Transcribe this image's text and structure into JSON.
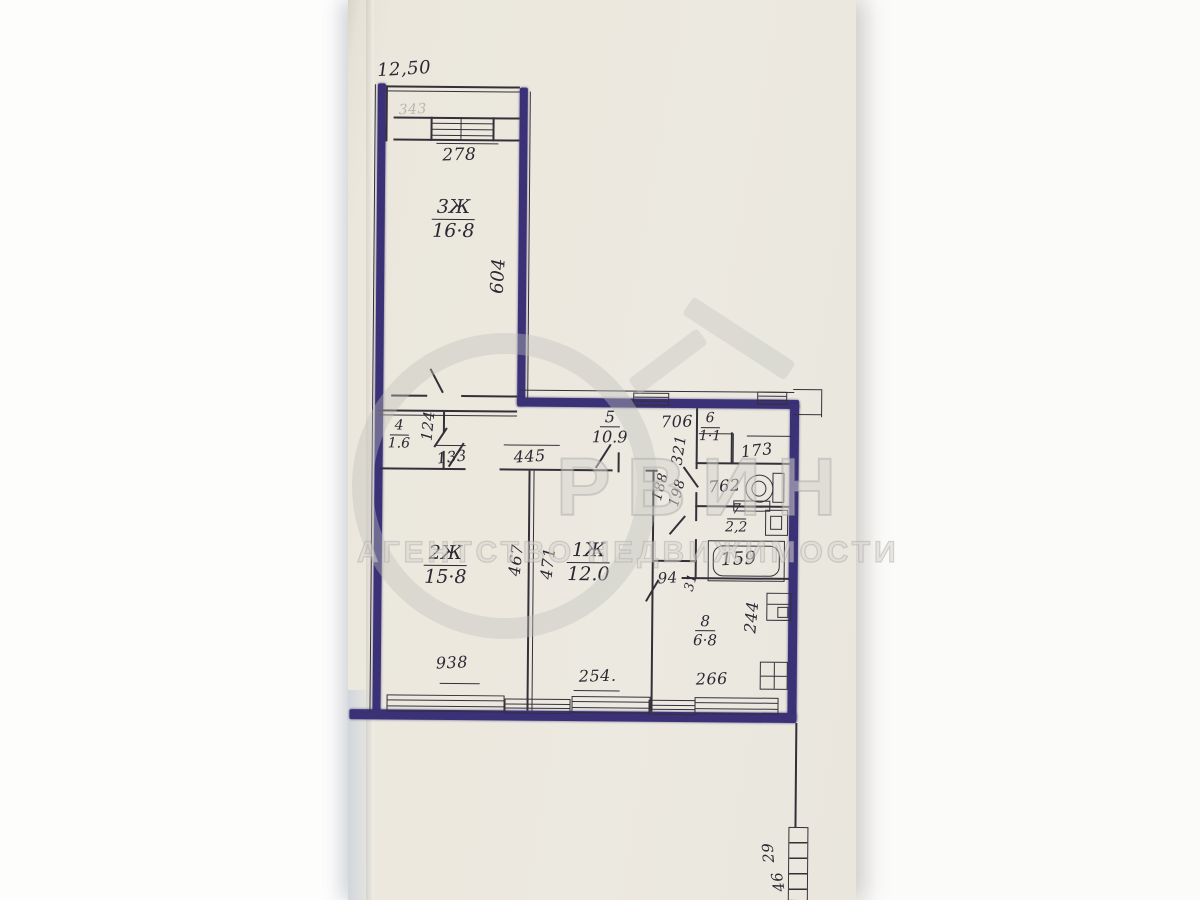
{
  "document": {
    "kind": "scanned apartment floor plan photograph"
  },
  "colors": {
    "paper": "#ebe7dc",
    "background": "#f7f6f4",
    "ink": "#34303a",
    "marker_wall": "#3a3177",
    "watermark": "#c9c8c4"
  },
  "watermark": {
    "brand": "РВИН",
    "tagline": "АГЕНТСТВО НЕДВИЖИМОСТИ",
    "logo": "house-in-circle"
  },
  "rooms": [
    {
      "id": "3",
      "num": "3Ж",
      "den": "16·8"
    },
    {
      "id": "4",
      "num": "4",
      "den": "1.6"
    },
    {
      "id": "5",
      "num": "5",
      "den": "10.9"
    },
    {
      "id": "6",
      "num": "6",
      "den": "1·1"
    },
    {
      "id": "7",
      "num": "7",
      "den": "2,2"
    },
    {
      "id": "2",
      "num": "2Ж",
      "den": "15·8"
    },
    {
      "id": "1",
      "num": "1Ж",
      "den": "12.0"
    },
    {
      "id": "8",
      "num": "8",
      "den": "6·8"
    }
  ],
  "dimensions": [
    {
      "text": "12,50"
    },
    {
      "text": "278"
    },
    {
      "text": "604"
    },
    {
      "text": "124"
    },
    {
      "text": "133"
    },
    {
      "text": "445"
    },
    {
      "text": "706"
    },
    {
      "text": "321"
    },
    {
      "text": "173"
    },
    {
      "text": "188"
    },
    {
      "text": "198"
    },
    {
      "text": "762"
    },
    {
      "text": "159"
    },
    {
      "text": "467"
    },
    {
      "text": "471"
    },
    {
      "text": "94"
    },
    {
      "text": "31"
    },
    {
      "text": "244"
    },
    {
      "text": "938"
    },
    {
      "text": "254."
    },
    {
      "text": "266"
    },
    {
      "text": "29"
    },
    {
      "text": "46"
    },
    {
      "text": "343"
    }
  ],
  "icons": {
    "toilet": "toilet-icon",
    "bathtub": "bathtub-icon",
    "washbasin": "washbasin-icon",
    "basin": "basin-icon",
    "kitchen_sink": "sink-icon",
    "stove": "stove-icon",
    "windows": "window-icon",
    "hatched_wall": "hatched-wall-icon"
  }
}
